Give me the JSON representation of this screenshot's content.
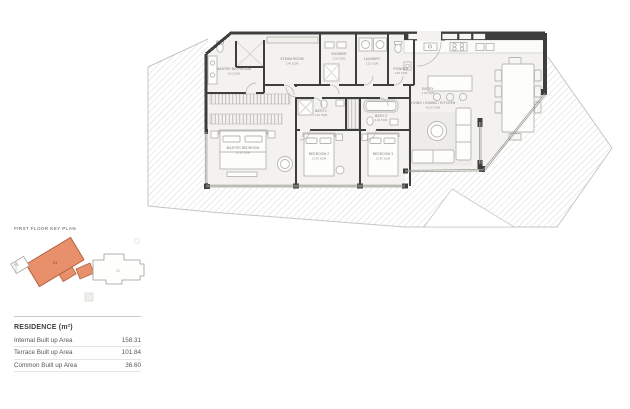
{
  "key_plan": {
    "title": "FIRST FLOOR KEY PLAN",
    "unit_label": "01",
    "adjacent_label": "02",
    "highlight_color": "#E8906C"
  },
  "legend": {
    "title": "RESIDENCE (m²)",
    "rows": [
      {
        "label": "Internal Built up Area",
        "value": "158.31"
      },
      {
        "label": "Terrace Built up Area",
        "value": "101.84"
      },
      {
        "label": "Common Built up Area",
        "value": "36.60"
      }
    ]
  },
  "floor_plan": {
    "rooms": {
      "master_bathroom": {
        "name": "MASTER BATHROOM",
        "area": "6.10 SQM"
      },
      "steam_room": {
        "name": "STEAM ROOM",
        "area": "3.40 SQM"
      },
      "shower": {
        "name": "SHOWER",
        "area": "3.20 SQM"
      },
      "laundry": {
        "name": "LAUNDRY",
        "area": "3.10 SQM"
      },
      "powder": {
        "name": "POWDER",
        "area": "2.60 SQM"
      },
      "entry": {
        "name": "ENTRY",
        "area": "4.10 SQM"
      },
      "living": {
        "name": "LIVING / DINING / KITCHEN",
        "area": "46.50 SQM"
      },
      "master_bedroom": {
        "name": "MASTER BEDROOM",
        "area": "18.30 SQM"
      },
      "bedroom_2": {
        "name": "BEDROOM 2",
        "area": "12.60 SQM"
      },
      "bedroom_3": {
        "name": "BEDROOM 3",
        "area": "12.80 SQM"
      },
      "bath_2": {
        "name": "BATH 2",
        "area": "4.20 SQM"
      },
      "bath_3": {
        "name": "BATH 3",
        "area": "4.40 SQM"
      }
    }
  }
}
